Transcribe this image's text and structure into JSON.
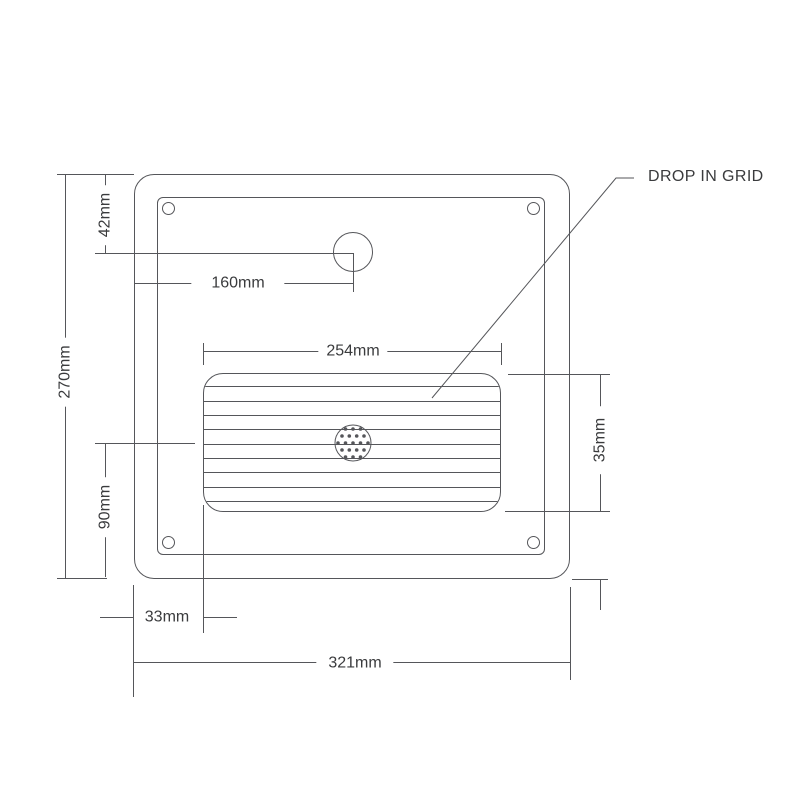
{
  "drawing": {
    "callout": "DROP IN GRID",
    "dimensions": {
      "tap_hole_top_offset": "42mm",
      "tap_hole_left_offset": "160mm",
      "panel_height": "270mm",
      "drain_center_bottom_offset": "90mm",
      "grid_width": "254mm",
      "grid_height": "35mm",
      "grid_left_offset": "33mm",
      "panel_width": "321mm"
    },
    "colors": {
      "line": "#55565a",
      "text": "#3a3b3d",
      "background": "#ffffff"
    }
  }
}
